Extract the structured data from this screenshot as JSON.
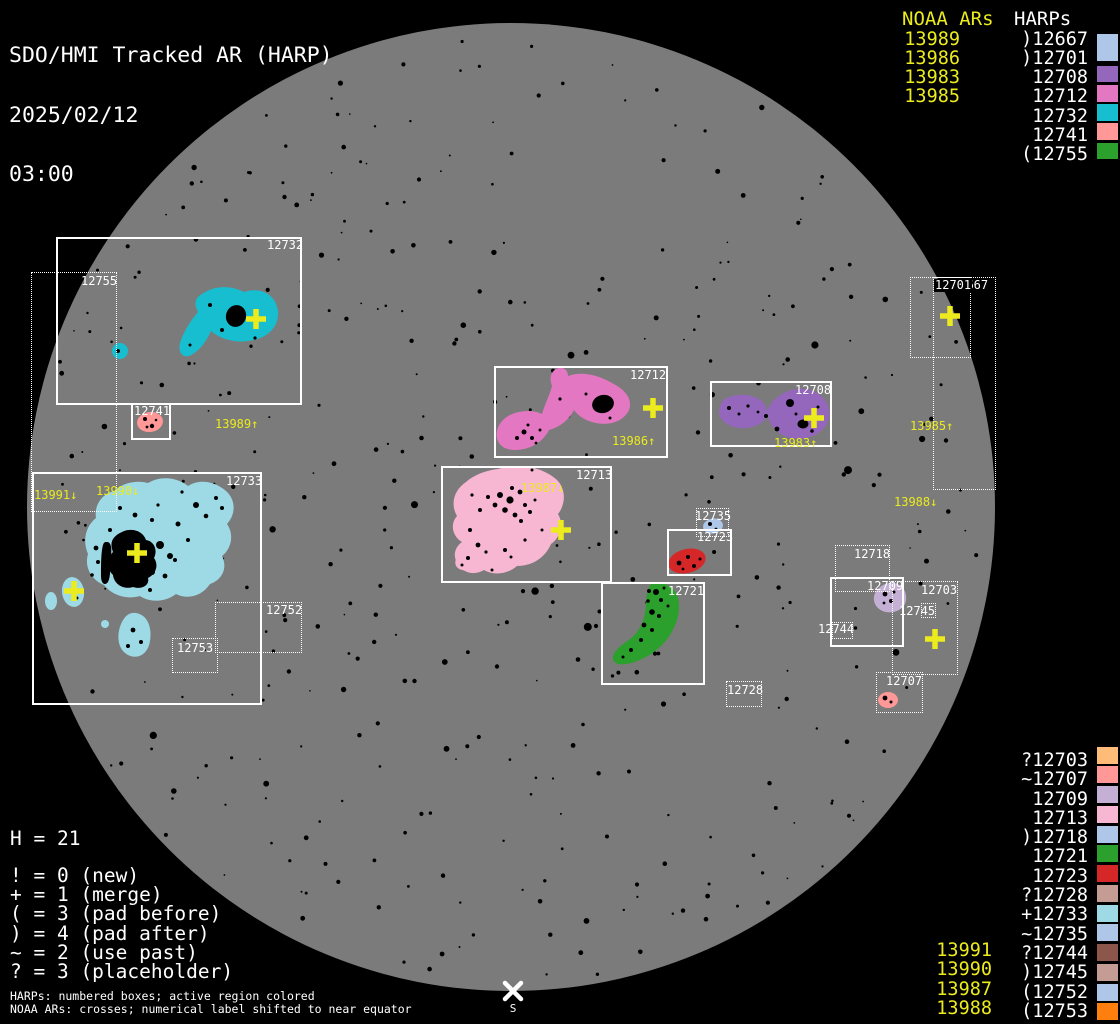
{
  "title": {
    "app": "SDO/HMI Tracked AR (HARP)",
    "date": "2025/02/12",
    "time": "03:00"
  },
  "colors": {
    "background": "#000000",
    "disk": "#7b7b7b",
    "box_line": "#ffffff",
    "yellow": "#ebeb1e",
    "white": "#ffffff",
    "regions": {
      "12732": "#17becf",
      "12741": "#ff9896",
      "12733": "#9edae5",
      "12712": "#e377c2",
      "12713": "#f7b6d2",
      "12708": "#9467bd",
      "12723": "#d62728",
      "12721": "#2ca02c",
      "12709": "#c5b0d5",
      "12707": "#ff9896",
      "12735": "#aec7e8"
    }
  },
  "top_right_legend": {
    "noaa_header": "NOAA ARs",
    "harps_header": "HARPs",
    "noaa": [
      "13989",
      "13986",
      "13983",
      "13985"
    ],
    "harps": [
      {
        "label": ")12667",
        "swatch": "#aec7e8",
        "tall": true
      },
      {
        "label": ")12701",
        "swatch": null
      },
      {
        "label": "12708",
        "swatch": "#9467bd"
      },
      {
        "label": "12712",
        "swatch": "#e377c2"
      },
      {
        "label": "12732",
        "swatch": "#17becf"
      },
      {
        "label": "12741",
        "swatch": "#ff9896"
      },
      {
        "label": "(12755",
        "swatch": "#2ca02c"
      }
    ]
  },
  "bottom_right_legend": {
    "harps": [
      {
        "label": "?12703",
        "swatch": "#ffbb78"
      },
      {
        "label": "~12707",
        "swatch": "#ff9896"
      },
      {
        "label": "12709",
        "swatch": "#c5b0d5"
      },
      {
        "label": "12713",
        "swatch": "#f7b6d2"
      },
      {
        "label": ")12718",
        "swatch": "#aec7e8"
      },
      {
        "label": "12721",
        "swatch": "#2ca02c"
      },
      {
        "label": "12723",
        "swatch": "#d62728"
      },
      {
        "label": "?12728",
        "swatch": "#c49c94"
      },
      {
        "label": "+12733",
        "swatch": "#9edae5"
      },
      {
        "label": "~12735",
        "swatch": "#aec7e8"
      },
      {
        "label": "?12744",
        "swatch": "#8c564b"
      },
      {
        "label": ")12745",
        "swatch": "#c49c94"
      },
      {
        "label": "(12752",
        "swatch": "#aec7e8"
      },
      {
        "label": "(12753",
        "swatch": "#ff7f0e"
      }
    ],
    "noaa": [
      "13991",
      "13990",
      "13987",
      "13988"
    ]
  },
  "status_legend": {
    "h_count": "H = 21",
    "codes": [
      "! = 0 (new)",
      "+ = 1 (merge)",
      "( = 3 (pad before)",
      ") = 4 (pad after)",
      "~ = 2 (use past)",
      "? = 3 (placeholder)"
    ]
  },
  "footnotes": [
    "HARPs: numbered boxes; active region colored",
    "NOAA ARs: crosses; numerical label shifted to near equator"
  ],
  "disk": {
    "cx": 511,
    "cy": 507,
    "r": 484
  },
  "south_marker": {
    "label": "S",
    "x": 513,
    "y": 991
  },
  "harp_boxes": [
    {
      "harp": "12732",
      "style": "solid",
      "x": 56,
      "y": 237,
      "w": 246,
      "h": 168,
      "lx": 267,
      "ly": 239
    },
    {
      "harp": "12755",
      "style": "dotted",
      "x": 31,
      "y": 272,
      "w": 86,
      "h": 240,
      "lx": 81,
      "ly": 275
    },
    {
      "harp": "12741",
      "style": "solid",
      "x": 131,
      "y": 403,
      "w": 40,
      "h": 37,
      "lx": 134,
      "ly": 405
    },
    {
      "harp": "12733",
      "style": "solid",
      "x": 32,
      "y": 472,
      "w": 230,
      "h": 233,
      "lx": 226,
      "ly": 475
    },
    {
      "harp": "12752",
      "style": "dotted",
      "x": 215,
      "y": 602,
      "w": 87,
      "h": 51,
      "lx": 266,
      "ly": 604
    },
    {
      "harp": "12753",
      "style": "dotted",
      "x": 172,
      "y": 638,
      "w": 46,
      "h": 35,
      "lx": 177,
      "ly": 642
    },
    {
      "harp": "12712",
      "style": "solid",
      "x": 494,
      "y": 366,
      "w": 174,
      "h": 92,
      "lx": 630,
      "ly": 369
    },
    {
      "harp": "12713",
      "style": "solid",
      "x": 441,
      "y": 466,
      "w": 171,
      "h": 117,
      "lx": 576,
      "ly": 469
    },
    {
      "harp": "12708",
      "style": "solid",
      "x": 710,
      "y": 381,
      "w": 122,
      "h": 66,
      "lx": 795,
      "ly": 384
    },
    {
      "harp": "12735",
      "style": "dotted",
      "x": 696,
      "y": 508,
      "w": 33,
      "h": 29,
      "lx": 695,
      "ly": 510
    },
    {
      "harp": "12723",
      "style": "solid",
      "x": 667,
      "y": 529,
      "w": 65,
      "h": 47,
      "lx": 697,
      "ly": 531
    },
    {
      "harp": "12721",
      "style": "solid",
      "x": 601,
      "y": 582,
      "w": 104,
      "h": 103,
      "lx": 668,
      "ly": 585
    },
    {
      "harp": "12728",
      "style": "dotted",
      "x": 726,
      "y": 681,
      "w": 36,
      "h": 26,
      "lx": 727,
      "ly": 684
    },
    {
      "harp": "12667",
      "style": "dotted",
      "x": 933,
      "y": 277,
      "w": 63,
      "h": 213,
      "lx": 952,
      "ly": 279
    },
    {
      "harp": "12701",
      "style": "dotted",
      "x": 910,
      "y": 277,
      "w": 61,
      "h": 81,
      "lx": 934,
      "ly": 279,
      "bg": true
    },
    {
      "harp": "12718",
      "style": "dotted",
      "x": 835,
      "y": 545,
      "w": 55,
      "h": 47,
      "lx": 854,
      "ly": 548
    },
    {
      "harp": "12709",
      "style": "solid",
      "x": 830,
      "y": 577,
      "w": 74,
      "h": 70,
      "lx": 867,
      "ly": 580
    },
    {
      "harp": "12703",
      "style": "dotted",
      "x": 892,
      "y": 581,
      "w": 66,
      "h": 94,
      "lx": 921,
      "ly": 584
    },
    {
      "harp": "12745",
      "style": "dotted",
      "x": 921,
      "y": 603,
      "w": 15,
      "h": 15,
      "lx": 899,
      "ly": 605
    },
    {
      "harp": "12744",
      "style": "dotted",
      "x": 832,
      "y": 622,
      "w": 21,
      "h": 17,
      "lx": 818,
      "ly": 623
    },
    {
      "harp": "12707",
      "style": "dotted",
      "x": 876,
      "y": 672,
      "w": 47,
      "h": 41,
      "lx": 886,
      "ly": 675
    }
  ],
  "noaa_disk_labels": [
    {
      "text": "13989↑",
      "x": 215,
      "y": 418
    },
    {
      "text": "13991↓",
      "x": 34,
      "y": 489
    },
    {
      "text": "13990↓",
      "x": 96,
      "y": 485
    },
    {
      "text": "13986↑",
      "x": 612,
      "y": 435
    },
    {
      "text": "13987↓",
      "x": 521,
      "y": 482
    },
    {
      "text": "13983↑",
      "x": 774,
      "y": 437
    },
    {
      "text": "13985↑",
      "x": 910,
      "y": 420
    },
    {
      "text": "13988↓",
      "x": 894,
      "y": 496
    }
  ],
  "crosses": [
    {
      "x": 256,
      "y": 319
    },
    {
      "x": 137,
      "y": 553
    },
    {
      "x": 74,
      "y": 591
    },
    {
      "x": 653,
      "y": 408
    },
    {
      "x": 561,
      "y": 530
    },
    {
      "x": 814,
      "y": 418
    },
    {
      "x": 950,
      "y": 316
    },
    {
      "x": 935,
      "y": 639
    }
  ]
}
